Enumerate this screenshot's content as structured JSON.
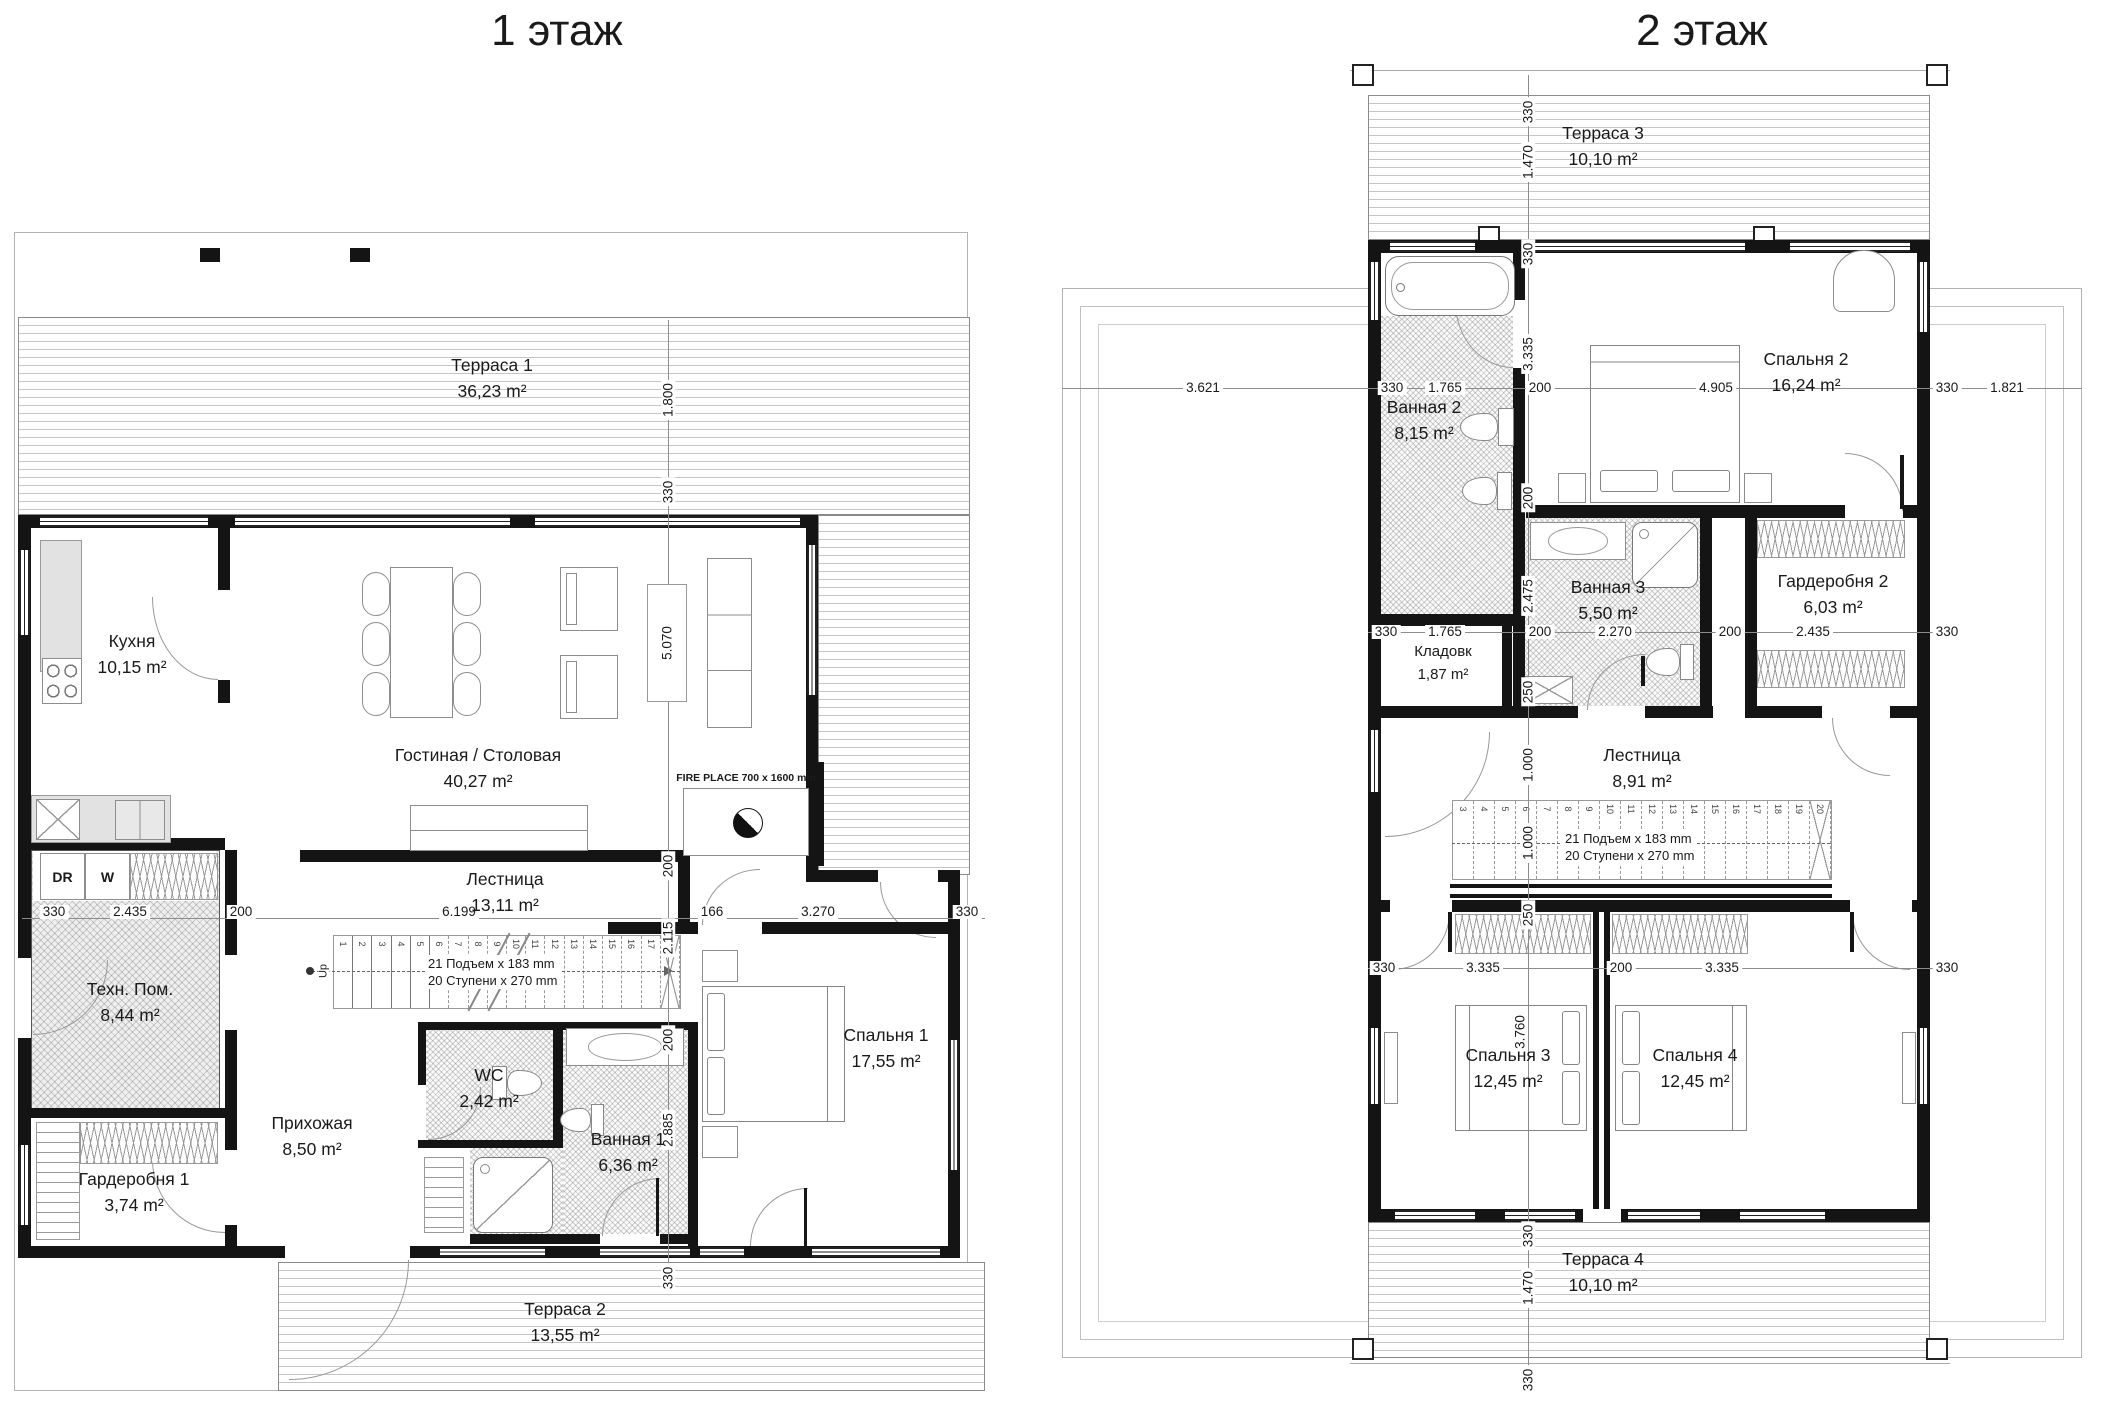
{
  "floor1": {
    "title": "1 этаж",
    "rooms": {
      "terrace1": {
        "name": "Терраса 1",
        "area": "36,23 m²"
      },
      "kitchen": {
        "name": "Кухня",
        "area": "10,15 m²"
      },
      "living": {
        "name": "Гостиная / Столовая",
        "area": "40,27 m²"
      },
      "stairs": {
        "name": "Лестница",
        "area": "13,11 m²"
      },
      "tech": {
        "name": "Техн. Пом.",
        "area": "8,44 m²"
      },
      "hallway": {
        "name": "Прихожая",
        "area": "8,50 m²"
      },
      "wc": {
        "name": "WC",
        "area": "2,42 m²"
      },
      "bath1": {
        "name": "Ванная 1",
        "area": "6,36 m²"
      },
      "bedroom1": {
        "name": "Спальня 1",
        "area": "17,55 m²"
      },
      "wardrobe1": {
        "name": "Гардеробня 1",
        "area": "3,74 m²"
      },
      "terrace2": {
        "name": "Терраса 2",
        "area": "13,55 m²"
      }
    },
    "labels": {
      "fireplace": "FIRE PLACE 700 x 1600 mm",
      "dryer": "DR",
      "washer": "W",
      "up": "Up",
      "stair_note1": "21 Подъем x 183 mm",
      "stair_note2": "20 Ступени x 270 mm"
    },
    "stair_treads": [
      "1",
      "2",
      "3",
      "4",
      "5",
      "6",
      "7",
      "8",
      "9",
      "10",
      "11",
      "12",
      "13",
      "14",
      "15",
      "16",
      "17",
      "18"
    ],
    "dims": {
      "v_terrace": "1.800",
      "v_wall_t": "330",
      "v_living": "5.070",
      "v_gap1": "200",
      "v_stairs": "2.115",
      "v_gap2": "200",
      "v_bath": "2.885",
      "v_wall_b": "330",
      "h_wall_l": "330",
      "h_tech": "2.435",
      "h_gap": "200",
      "h_stairs": "6.199",
      "h_166": "166",
      "h_bed": "3.270",
      "h_wall_r": "330"
    }
  },
  "floor2": {
    "title": "2 этаж",
    "rooms": {
      "terrace3": {
        "name": "Терраса 3",
        "area": "10,10 m²"
      },
      "bath2": {
        "name": "Ванная 2",
        "area": "8,15 m²"
      },
      "bedroom2": {
        "name": "Спальня 2",
        "area": "16,24 m²"
      },
      "bath3": {
        "name": "Ванная 3",
        "area": "5,50 m²"
      },
      "storage": {
        "name": "Кладовк",
        "area": "1,87 m²"
      },
      "wardrobe2": {
        "name": "Гардеробня 2",
        "area": "6,03 m²"
      },
      "stairs": {
        "name": "Лестница",
        "area": "8,91 m²"
      },
      "bedroom3": {
        "name": "Спальня 3",
        "area": "12,45 m²"
      },
      "bedroom4": {
        "name": "Спальня 4",
        "area": "12,45 m²"
      },
      "terrace4": {
        "name": "Терраса 4",
        "area": "10,10 m²"
      }
    },
    "labels": {
      "stair_note1": "21 Подъем x 183 mm",
      "stair_note2": "20 Ступени x 270 mm"
    },
    "stair_treads": [
      "3",
      "4",
      "5",
      "6",
      "7",
      "8",
      "9",
      "10",
      "11",
      "12",
      "13",
      "14",
      "15",
      "16",
      "17",
      "18",
      "19",
      "20"
    ],
    "dims": {
      "roof_left": "3.621",
      "top_330a": "330",
      "top_1765": "1.765",
      "top_200": "200",
      "top_4905": "4.905",
      "top_330b": "330",
      "top_1821": "1.821",
      "mid_330a": "330",
      "mid_1765": "1.765",
      "mid_200a": "200",
      "mid_2270": "2.270",
      "mid_200b": "200",
      "mid_2435": "2.435",
      "mid_330b": "330",
      "bot_330a": "330",
      "bot_3335a": "3.335",
      "bot_200": "200",
      "bot_3335b": "3.335",
      "bot_330b": "330",
      "v_330a": "330",
      "v_1470a": "1.470",
      "v_330b": "330",
      "v_3335": "3.335",
      "v_200a": "200",
      "v_2475": "2.475",
      "v_250a": "250",
      "v_1000a": "1.000",
      "v_1000b": "1.000",
      "v_250b": "250",
      "v_3760": "3.760",
      "v_330c": "330",
      "v_1470b": "1.470",
      "v_330d": "330"
    }
  }
}
